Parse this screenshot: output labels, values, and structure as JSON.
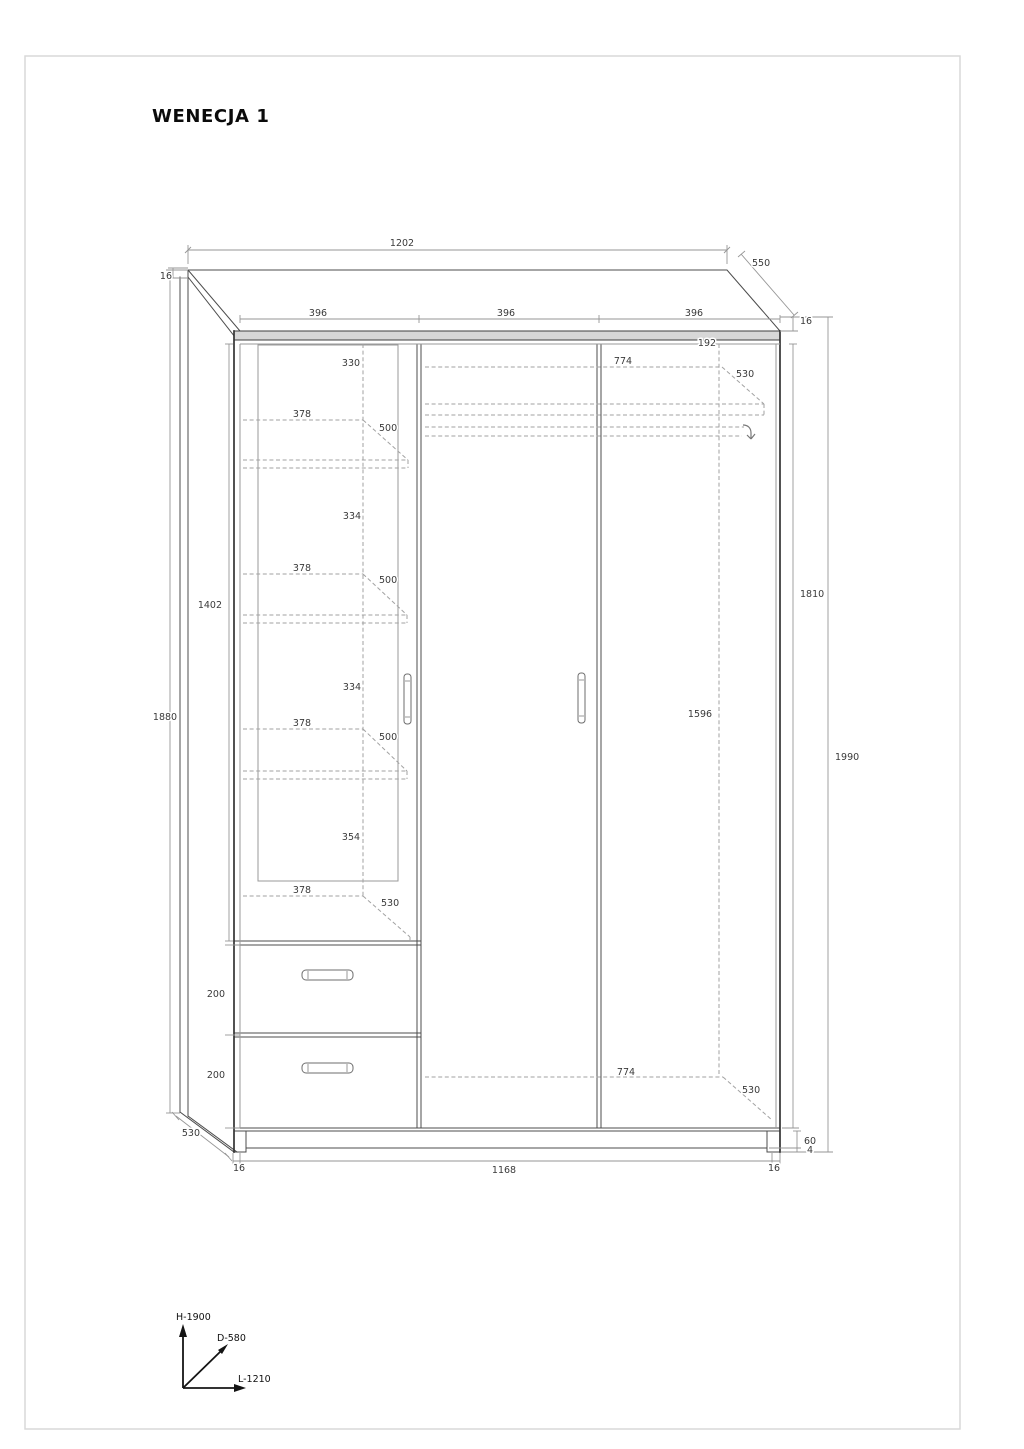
{
  "page": {
    "title": "WENECJA 1"
  },
  "drawing": {
    "product": "wardrobe technical drawing",
    "dimension_labels": [
      {
        "id": "total-width",
        "text": "1202",
        "x": 402,
        "y": 246,
        "anchor": "middle"
      },
      {
        "id": "top-depth",
        "text": "550",
        "x": 752,
        "y": 266,
        "anchor": "start"
      },
      {
        "id": "top-thickness-left",
        "text": "16",
        "x": 172,
        "y": 279,
        "anchor": "end"
      },
      {
        "id": "door-width-1",
        "text": "396",
        "x": 318,
        "y": 316,
        "anchor": "middle"
      },
      {
        "id": "door-width-2",
        "text": "396",
        "x": 506,
        "y": 316,
        "anchor": "middle"
      },
      {
        "id": "door-width-3",
        "text": "396",
        "x": 694,
        "y": 316,
        "anchor": "middle"
      },
      {
        "id": "top-thickness-right",
        "text": "16",
        "x": 800,
        "y": 324,
        "anchor": "start"
      },
      {
        "id": "top-gap",
        "text": "192",
        "x": 707,
        "y": 346,
        "anchor": "middle"
      },
      {
        "id": "top-shelf-width",
        "text": "774",
        "x": 623,
        "y": 364,
        "anchor": "middle"
      },
      {
        "id": "top-shelf-depth",
        "text": "530",
        "x": 736,
        "y": 377,
        "anchor": "start"
      },
      {
        "id": "glass-top-offset",
        "text": "330",
        "x": 351,
        "y": 366,
        "anchor": "middle"
      },
      {
        "id": "shelf1-width",
        "text": "378",
        "x": 302,
        "y": 417,
        "anchor": "middle"
      },
      {
        "id": "shelf1-depth",
        "text": "500",
        "x": 379,
        "y": 431,
        "anchor": "start"
      },
      {
        "id": "shelf2-gap",
        "text": "334",
        "x": 352,
        "y": 519,
        "anchor": "middle"
      },
      {
        "id": "shelf2-width",
        "text": "378",
        "x": 302,
        "y": 571,
        "anchor": "middle"
      },
      {
        "id": "shelf2-depth",
        "text": "500",
        "x": 379,
        "y": 583,
        "anchor": "start"
      },
      {
        "id": "interior-height",
        "text": "1402",
        "x": 222,
        "y": 608,
        "anchor": "end"
      },
      {
        "id": "door-height",
        "text": "1810",
        "x": 800,
        "y": 597,
        "anchor": "start"
      },
      {
        "id": "shelf3-gap",
        "text": "334",
        "x": 352,
        "y": 690,
        "anchor": "middle"
      },
      {
        "id": "side-height",
        "text": "1880",
        "x": 165,
        "y": 720,
        "anchor": "middle"
      },
      {
        "id": "hanging-height",
        "text": "1596",
        "x": 700,
        "y": 717,
        "anchor": "middle"
      },
      {
        "id": "shelf3-width",
        "text": "378",
        "x": 302,
        "y": 726,
        "anchor": "middle"
      },
      {
        "id": "shelf3-depth",
        "text": "500",
        "x": 379,
        "y": 740,
        "anchor": "start"
      },
      {
        "id": "total-height",
        "text": "1990",
        "x": 835,
        "y": 760,
        "anchor": "start"
      },
      {
        "id": "shelf4-gap",
        "text": "354",
        "x": 351,
        "y": 840,
        "anchor": "middle"
      },
      {
        "id": "shelf4-width",
        "text": "378",
        "x": 302,
        "y": 893,
        "anchor": "middle"
      },
      {
        "id": "shelf4-depth",
        "text": "530",
        "x": 381,
        "y": 906,
        "anchor": "start"
      },
      {
        "id": "drawer1-height",
        "text": "200",
        "x": 225,
        "y": 997,
        "anchor": "end"
      },
      {
        "id": "drawer2-height",
        "text": "200",
        "x": 225,
        "y": 1078,
        "anchor": "end"
      },
      {
        "id": "bottom-shelf-width",
        "text": "774",
        "x": 626,
        "y": 1075,
        "anchor": "middle"
      },
      {
        "id": "bottom-shelf-depth",
        "text": "530",
        "x": 742,
        "y": 1093,
        "anchor": "start"
      },
      {
        "id": "side-depth",
        "text": "530",
        "x": 200,
        "y": 1136,
        "anchor": "end"
      },
      {
        "id": "plinth-height",
        "text": "60",
        "x": 804,
        "y": 1144,
        "anchor": "start"
      },
      {
        "id": "foot-height",
        "text": "4",
        "x": 807,
        "y": 1153,
        "anchor": "start"
      },
      {
        "id": "side-thickness-left",
        "text": "16",
        "x": 239,
        "y": 1171,
        "anchor": "middle"
      },
      {
        "id": "inner-width",
        "text": "1168",
        "x": 504,
        "y": 1173,
        "anchor": "middle"
      },
      {
        "id": "side-thickness-right",
        "text": "16",
        "x": 774,
        "y": 1171,
        "anchor": "middle"
      }
    ],
    "axis_legend": {
      "height": "H-1900",
      "depth": "D-580",
      "length": "L-1210"
    }
  }
}
